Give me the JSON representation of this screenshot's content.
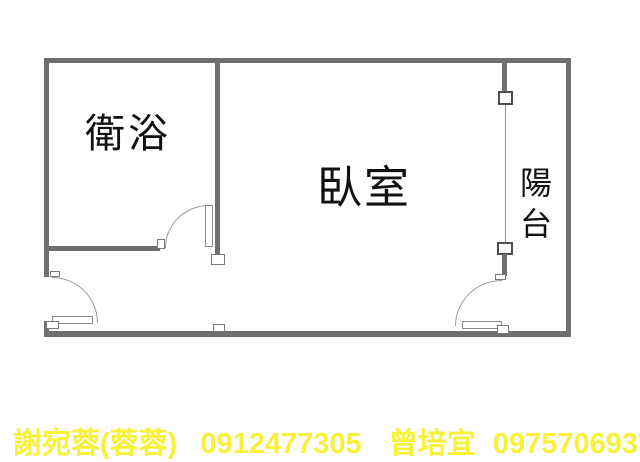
{
  "plan": {
    "bathroom_label": "衛浴",
    "bedroom_label": "臥室",
    "balcony_label": "陽台"
  },
  "contact": {
    "agent1_name": "謝宛蓉(蓉蓉)",
    "agent1_phone": "0912477305",
    "agent2_name": "曾培宜",
    "agent2_phone": "0975706937"
  },
  "colors": {
    "background": "#ffffff",
    "wall": "#6f6f6f",
    "door_line": "#999999",
    "room_label_text": "#111111",
    "contact_text": "#f8f13a"
  }
}
